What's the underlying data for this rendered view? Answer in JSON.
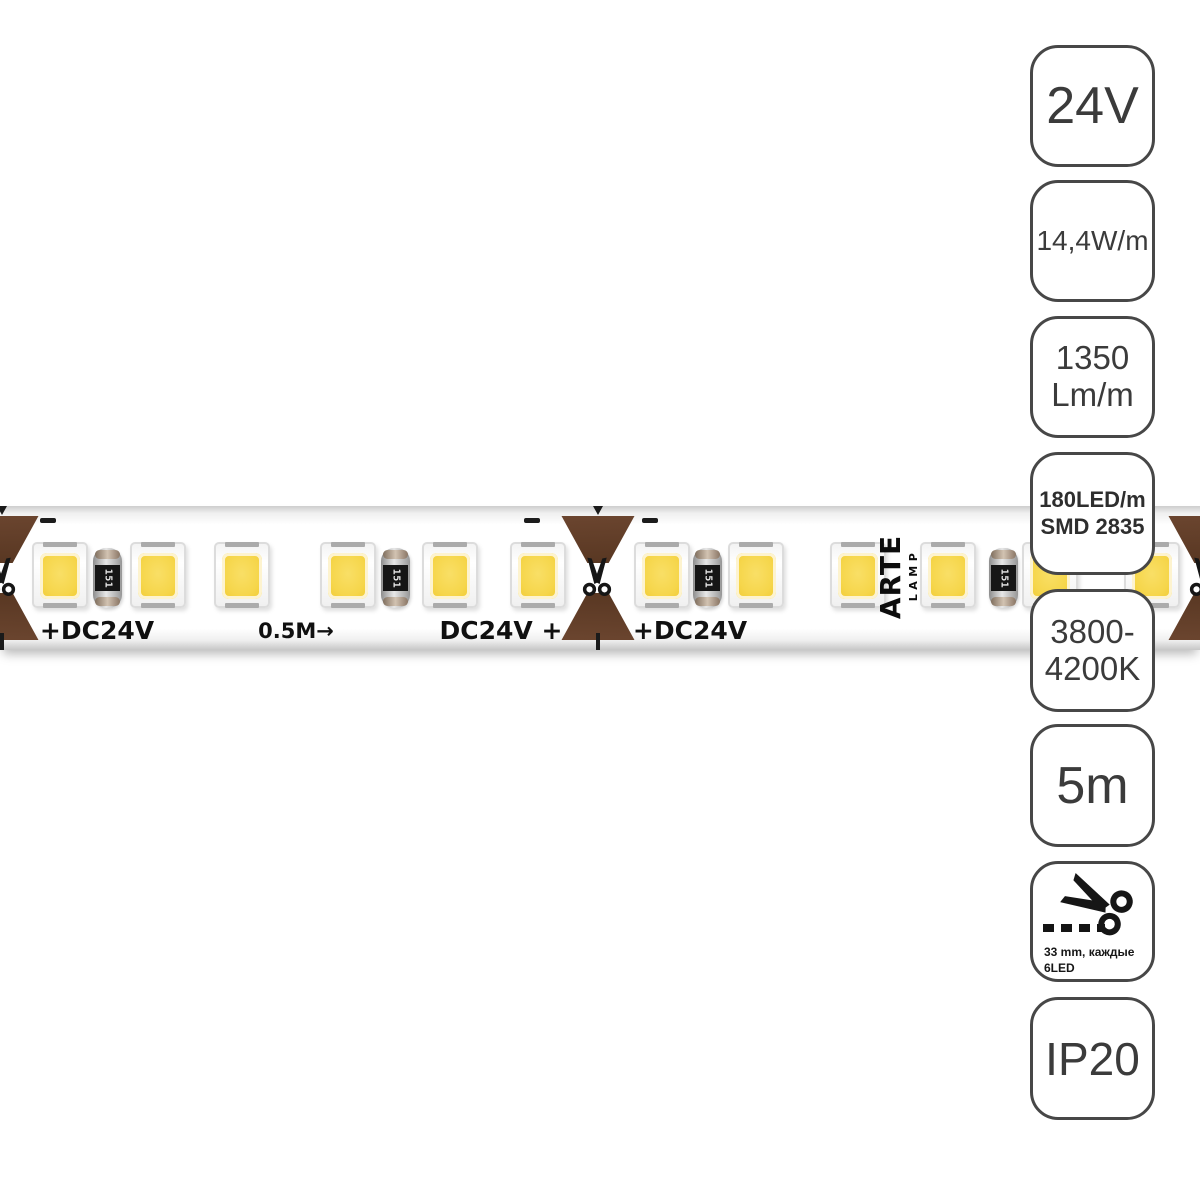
{
  "strip": {
    "texts": {
      "plus_dc24v_left": "+DC24V",
      "half_meter_mark": "0.5M→",
      "dc24v_plus": "DC24V +",
      "plus_dc24v_right": "+DC24V"
    },
    "resistor_label": "151",
    "logo": {
      "brand": "ARTE",
      "sub": "LAMP"
    }
  },
  "badges": [
    {
      "id": "voltage",
      "line1": "24V"
    },
    {
      "id": "power-per-meter",
      "line1": "14,4W/m"
    },
    {
      "id": "luminous-flux",
      "line1": "1350",
      "line2": "Lm/m"
    },
    {
      "id": "led-density",
      "line1": "180LED/m",
      "line2": "SMD 2835"
    },
    {
      "id": "color-temperature",
      "line1": "3800-",
      "line2": "4200K"
    },
    {
      "id": "length",
      "line1": "5m"
    },
    {
      "id": "cut-interval",
      "caption1": "33 mm, каждые",
      "caption2": "6LED"
    },
    {
      "id": "ip-rating",
      "line1": "IP20"
    }
  ],
  "colors": {
    "led_yellow": "#f6d64b",
    "copper_pad_brown": "#5e3c29",
    "badge_border": "#474747",
    "strip_text": "#101010"
  }
}
